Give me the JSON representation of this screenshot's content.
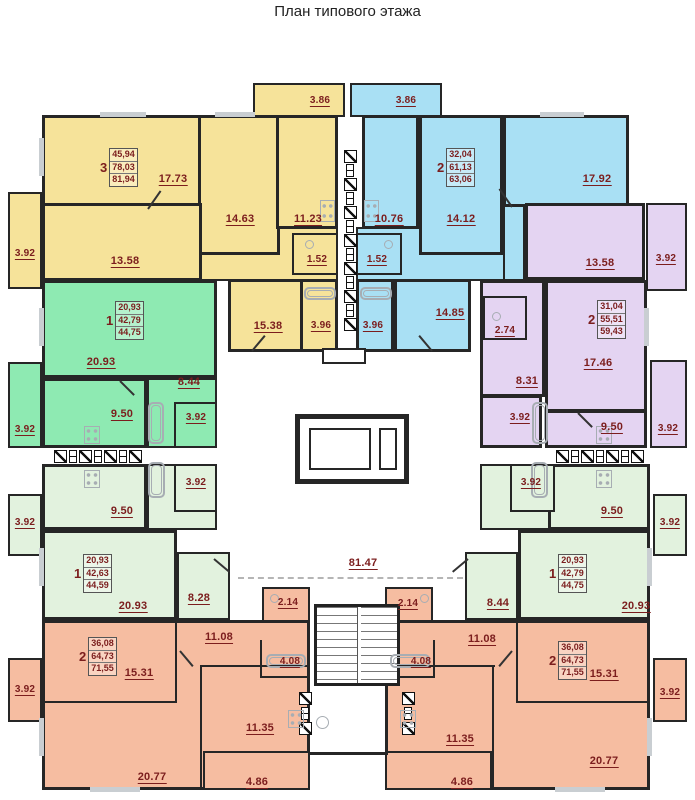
{
  "title": "План типового этажа",
  "colors": {
    "apartment_3room_yellow": "#f6e39a",
    "apartment_2room_blue": "#a9e0f4",
    "apartment_2room_purple": "#e4d4f2",
    "apartment_1room_green": "#8eeab2",
    "apartment_1room_lightgreen": "#e2f2de",
    "apartment_2room_salmon": "#f6bda1",
    "wall": "#262626",
    "dimension_label": "#7b1d1d"
  },
  "apartments": {
    "apt_y": {
      "rooms": "3",
      "a1": "45,94",
      "a2": "78,03",
      "a3": "81,94"
    },
    "apt_b": {
      "rooms": "2",
      "a1": "32,04",
      "a2": "61,13",
      "a3": "63,06"
    },
    "apt_p": {
      "rooms": "2",
      "a1": "31,04",
      "a2": "55,51",
      "a3": "59,43"
    },
    "apt_g": {
      "rooms": "1",
      "a1": "20,93",
      "a2": "42,79",
      "a3": "44,75"
    },
    "apt_l": {
      "rooms": "1",
      "a1": "20,93",
      "a2": "42,63",
      "a3": "44,59"
    },
    "apt_r": {
      "rooms": "1",
      "a1": "20,93",
      "a2": "42,79",
      "a3": "44,75"
    },
    "apt_sl": {
      "rooms": "2",
      "a1": "36,08",
      "a2": "64,73",
      "a3": "71,55"
    },
    "apt_sr": {
      "rooms": "2",
      "a1": "36,08",
      "a2": "64,73",
      "a3": "71,55"
    }
  },
  "areas": {
    "y_living": "17.73",
    "y_bed": "14.63",
    "y_kitchen": "11.23",
    "y_bed2": "13.58",
    "y_wc": "1.52",
    "y_hall": "15.38",
    "y_bath": "3.96",
    "y_balc": "3.92",
    "y_loggia": "3.86",
    "b_kitchen": "10.76",
    "b_bed": "14.12",
    "b_living": "17.92",
    "b_wc": "1.52",
    "b_bath": "3.96",
    "b_kitchen2": "14.85",
    "b_loggia": "3.86",
    "p_bed": "13.58",
    "p_living": "17.46",
    "p_hall": "8.31",
    "p_wc": "2.74",
    "p_bath": "3.92",
    "p_kitchen": "9.50",
    "p_balc1": "3.92",
    "p_balc2": "3.92",
    "g_living": "20.93",
    "g_hall": "8.44",
    "g_kitchen": "9.50",
    "g_bath": "3.92",
    "g_balc": "3.92",
    "l_kitchen": "9.50",
    "l_bath": "3.92",
    "l_living": "20.93",
    "l_hall": "8.28",
    "l_balc": "3.92",
    "r_kitchen": "9.50",
    "r_bath": "3.92",
    "r_living": "20.93",
    "r_hall": "8.44",
    "r_balc": "3.92",
    "sl_kitchen": "11.08",
    "sl_wc": "2.14",
    "sl_bath": "4.08",
    "sl_room1": "15.31",
    "sl_room2": "20.77",
    "sl_room3": "11.35",
    "sl_balc": "3.92",
    "sl_loggia": "4.86",
    "sr_kitchen": "11.08",
    "sr_wc": "2.14",
    "sr_bath": "4.08",
    "sr_room1": "15.31",
    "sr_room2": "20.77",
    "sr_room3": "11.35",
    "sr_balc": "3.92",
    "sr_loggia": "4.86",
    "corridor": "81.47"
  }
}
